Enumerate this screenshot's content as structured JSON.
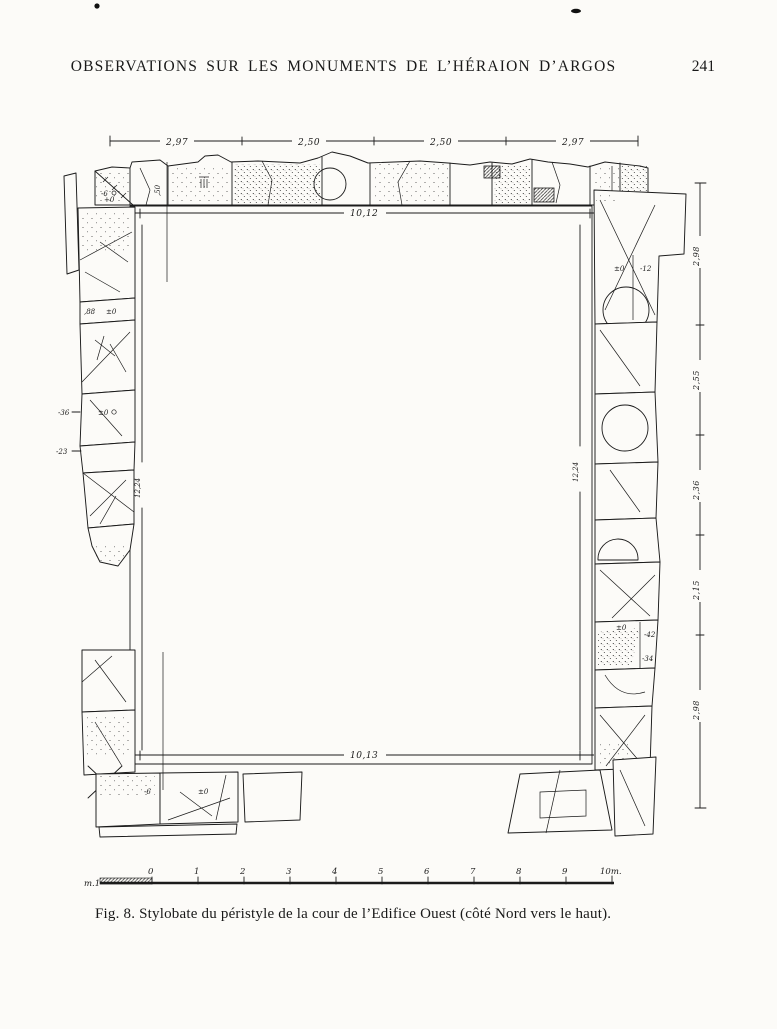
{
  "header": {
    "title": "OBSERVATIONS SUR LES MONUMENTS DE L’HÉRAION D’ARGOS",
    "page_number": "241"
  },
  "caption": "Fig. 8.  Stylobate du péristyle de la cour de l’Edifice Ouest (côté Nord vers le haut).",
  "dims": {
    "top": [
      "2,97",
      "2,50",
      "2,50",
      "2,97"
    ],
    "court_top": "10,12",
    "court_bottom": "10,13",
    "court_left": "12,24",
    "court_right": "12,24",
    "band_tl": ",88",
    "band_tr": ",82",
    "band_bl": ",81",
    "band_br": ",80",
    "depth_left": ",50",
    "depth_right": ",50"
  },
  "ruler": {
    "segments": [
      "2,98",
      "2,55",
      "2,36",
      "2,15",
      "2,98"
    ]
  },
  "levels": {
    "tl_minus6": "-6",
    "tl_plus0": "+0",
    "west_88": ",88",
    "west_pm0": "±0",
    "west_minus36": "-36",
    "west_pm0b": "±0",
    "west_minus23": "-23",
    "east_pm0_upper": "±0",
    "east_minus12": "-12",
    "east_pm0_lower": "±0",
    "east_minus42": "-42",
    "east_minus34": "-34",
    "south_minus6": "-6",
    "south_pm0": "±0"
  },
  "scale": {
    "left_label": "m.1",
    "ticks": [
      "0",
      "1",
      "2",
      "3",
      "4",
      "5",
      "6",
      "7",
      "8",
      "9"
    ],
    "right_label": "10m."
  },
  "colors": {
    "ink": "#1b1b1b",
    "paper": "#fcfbf8"
  }
}
